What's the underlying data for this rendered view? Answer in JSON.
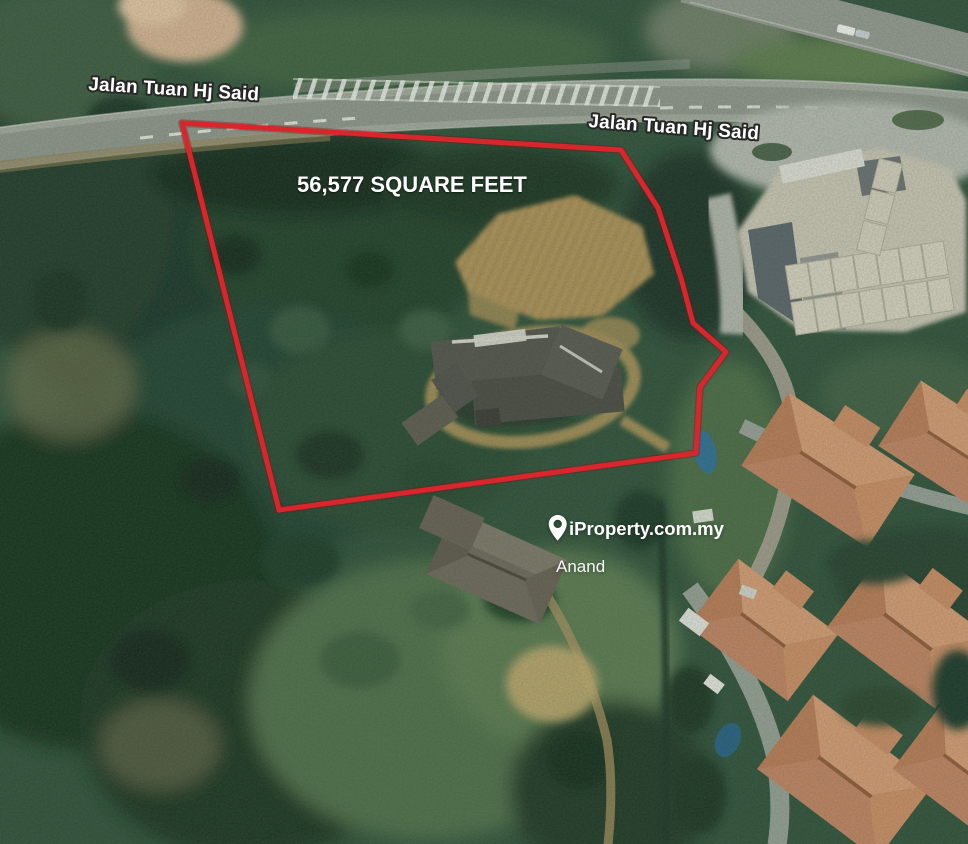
{
  "map": {
    "type": "satellite-property-listing",
    "road_labels": [
      {
        "text": "Jalan Tuan Hj Said"
      },
      {
        "text": "Jalan Tuan Hj Said"
      }
    ],
    "parcel": {
      "area_label": "56,577 SQUARE FEET",
      "area_sqft": 56577,
      "outline_color": "#d9262c",
      "points": "182,123 621,150 658,208 681,278 693,323 726,352 700,387 696,453 279,510"
    },
    "watermark": {
      "icon": "location-pin",
      "brand": "iProperty.com.my",
      "agent": "Anand",
      "color": "#ffffff"
    }
  }
}
